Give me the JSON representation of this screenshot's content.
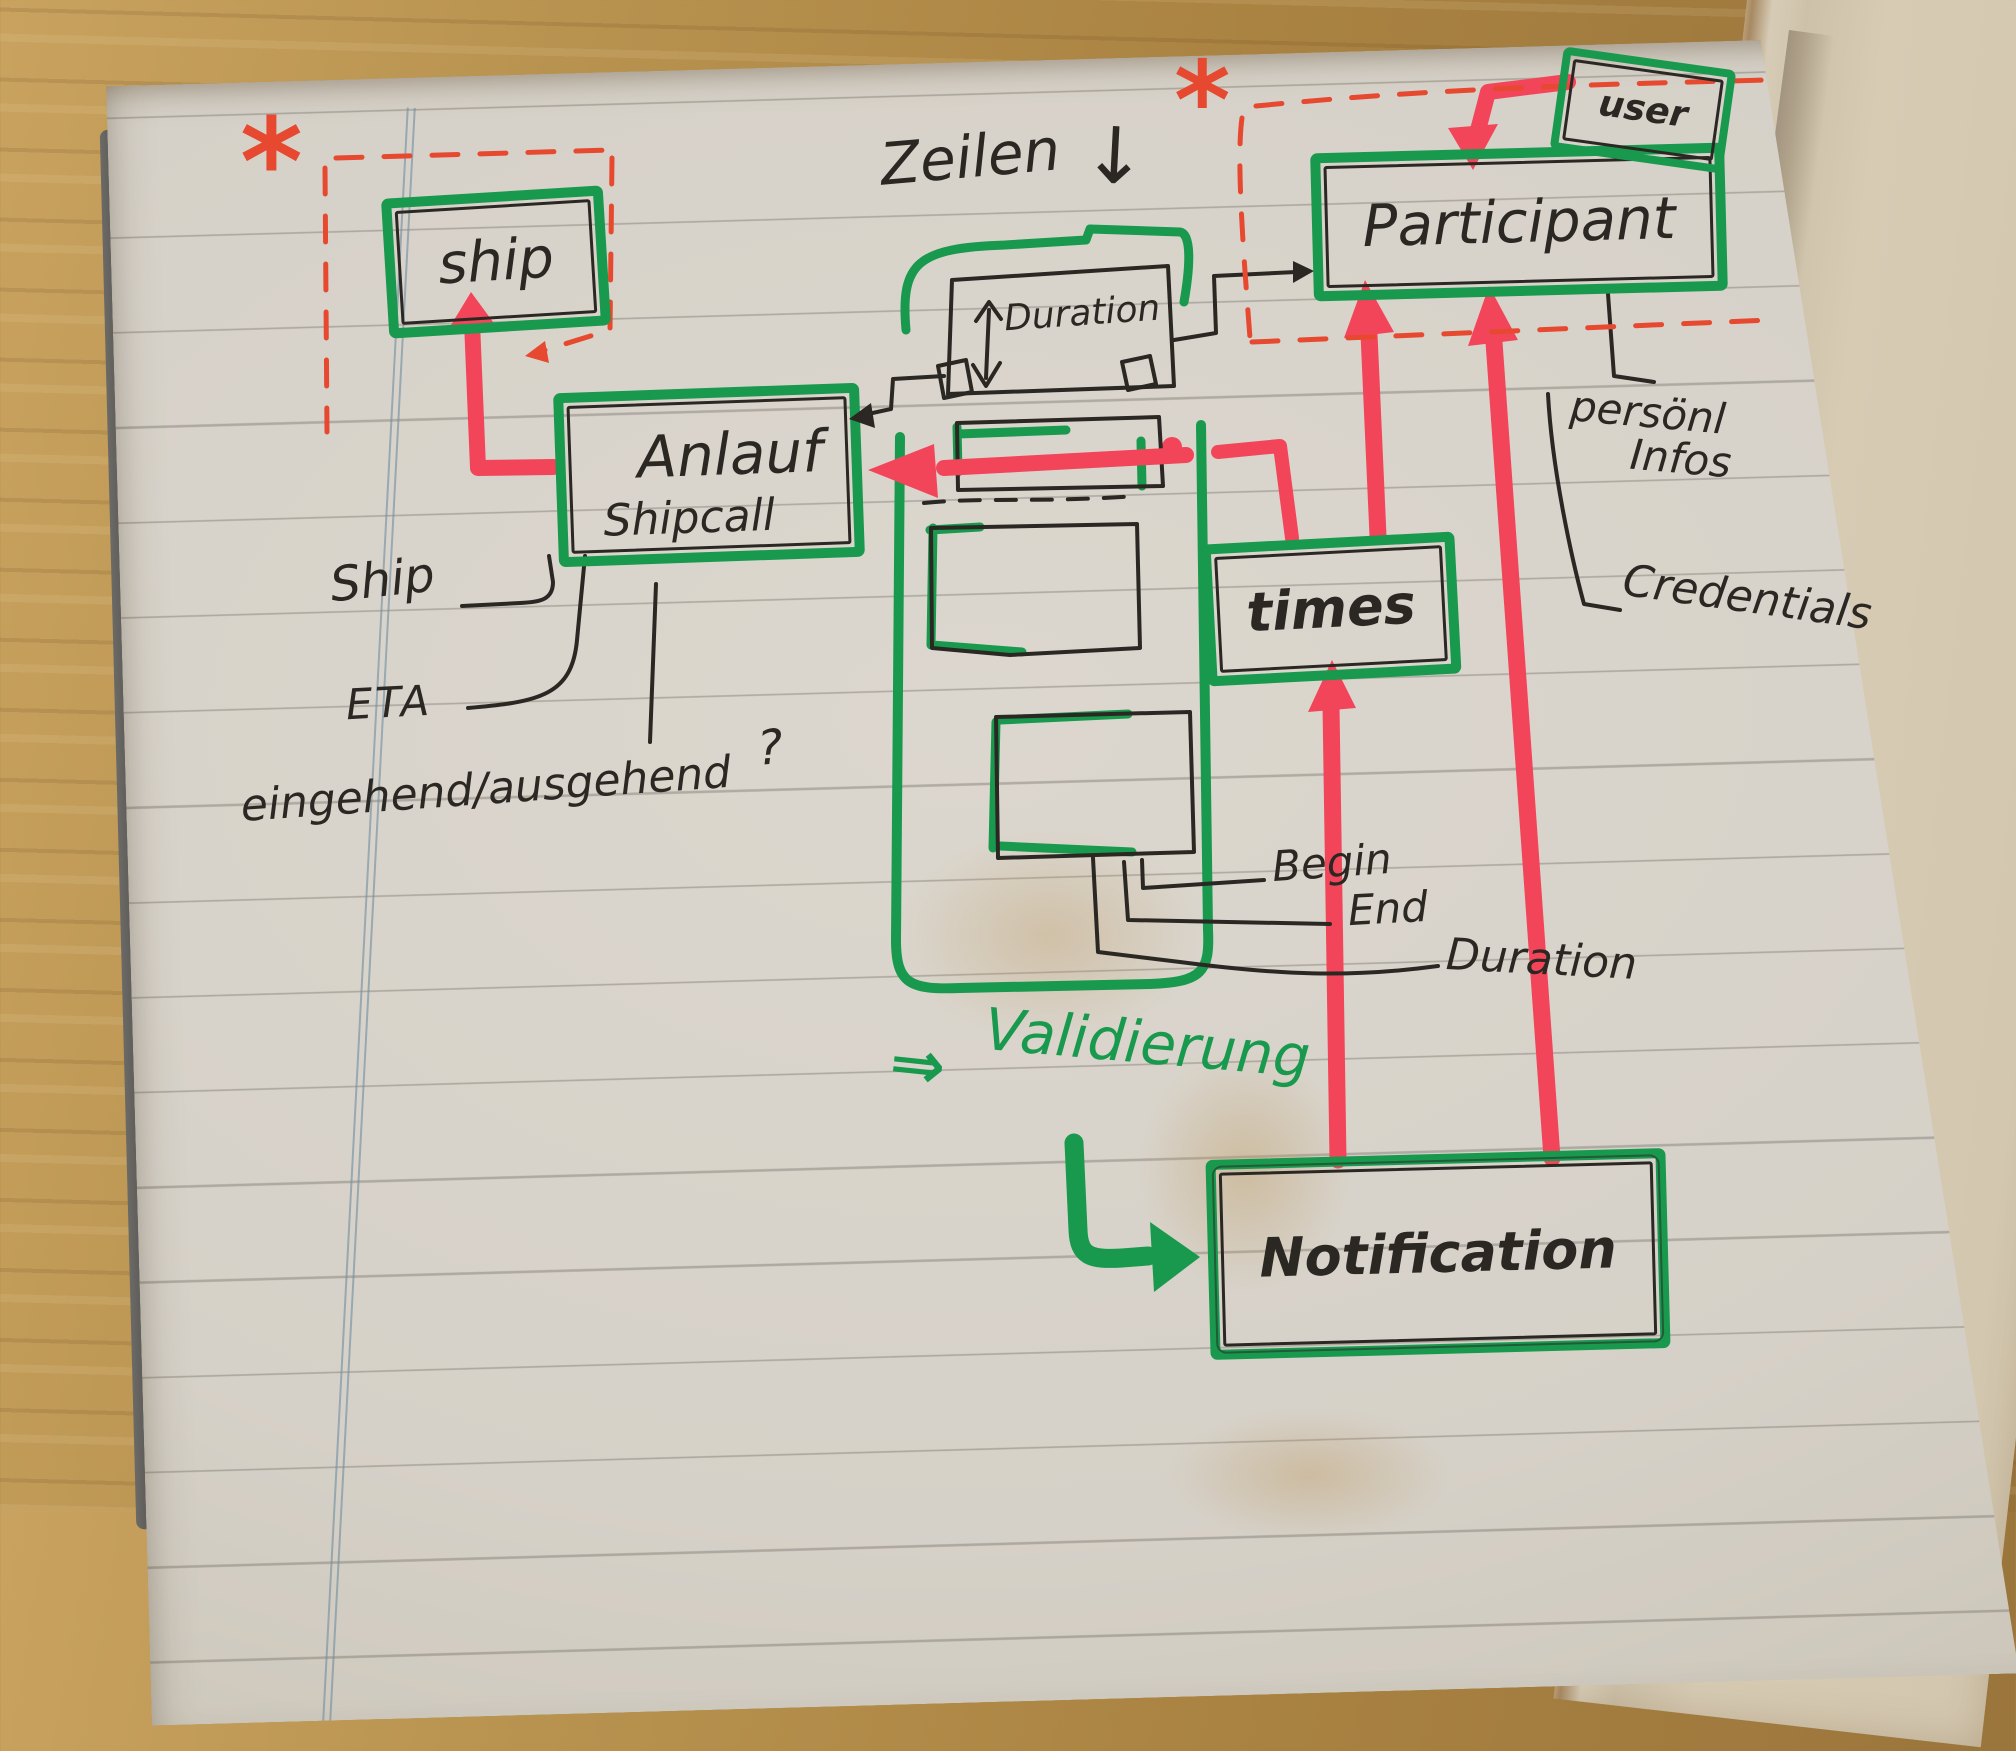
{
  "notebook": {
    "entities": {
      "ship": "ship",
      "anlauf": "Anlauf",
      "anlauf_sub": "Shipcall",
      "participant": "Participant",
      "user": "user",
      "times": "times",
      "notification": "Notification",
      "duration_box": "Duration"
    },
    "annotations": {
      "zeilen": "Zeilen",
      "zeilen_arrow": "↓",
      "ship_attr": "Ship",
      "eta": "ETA",
      "inout": "eingehend/ausgehend",
      "inout_q": "?",
      "begin": "Begin",
      "end": "End",
      "duration": "Duration",
      "personal_1": "persönl",
      "personal_2": "Infos",
      "credentials": "Credentials",
      "validierung_arrow": "⇒",
      "validierung": "Validierung",
      "asterisk": "*"
    },
    "colors": {
      "marker_green": "#18994e",
      "marker_red": "#f3455a",
      "pen_red": "#e6492f",
      "pen_black": "#2b2824",
      "page": "#d9d4cb",
      "wood": "#b08948"
    }
  }
}
